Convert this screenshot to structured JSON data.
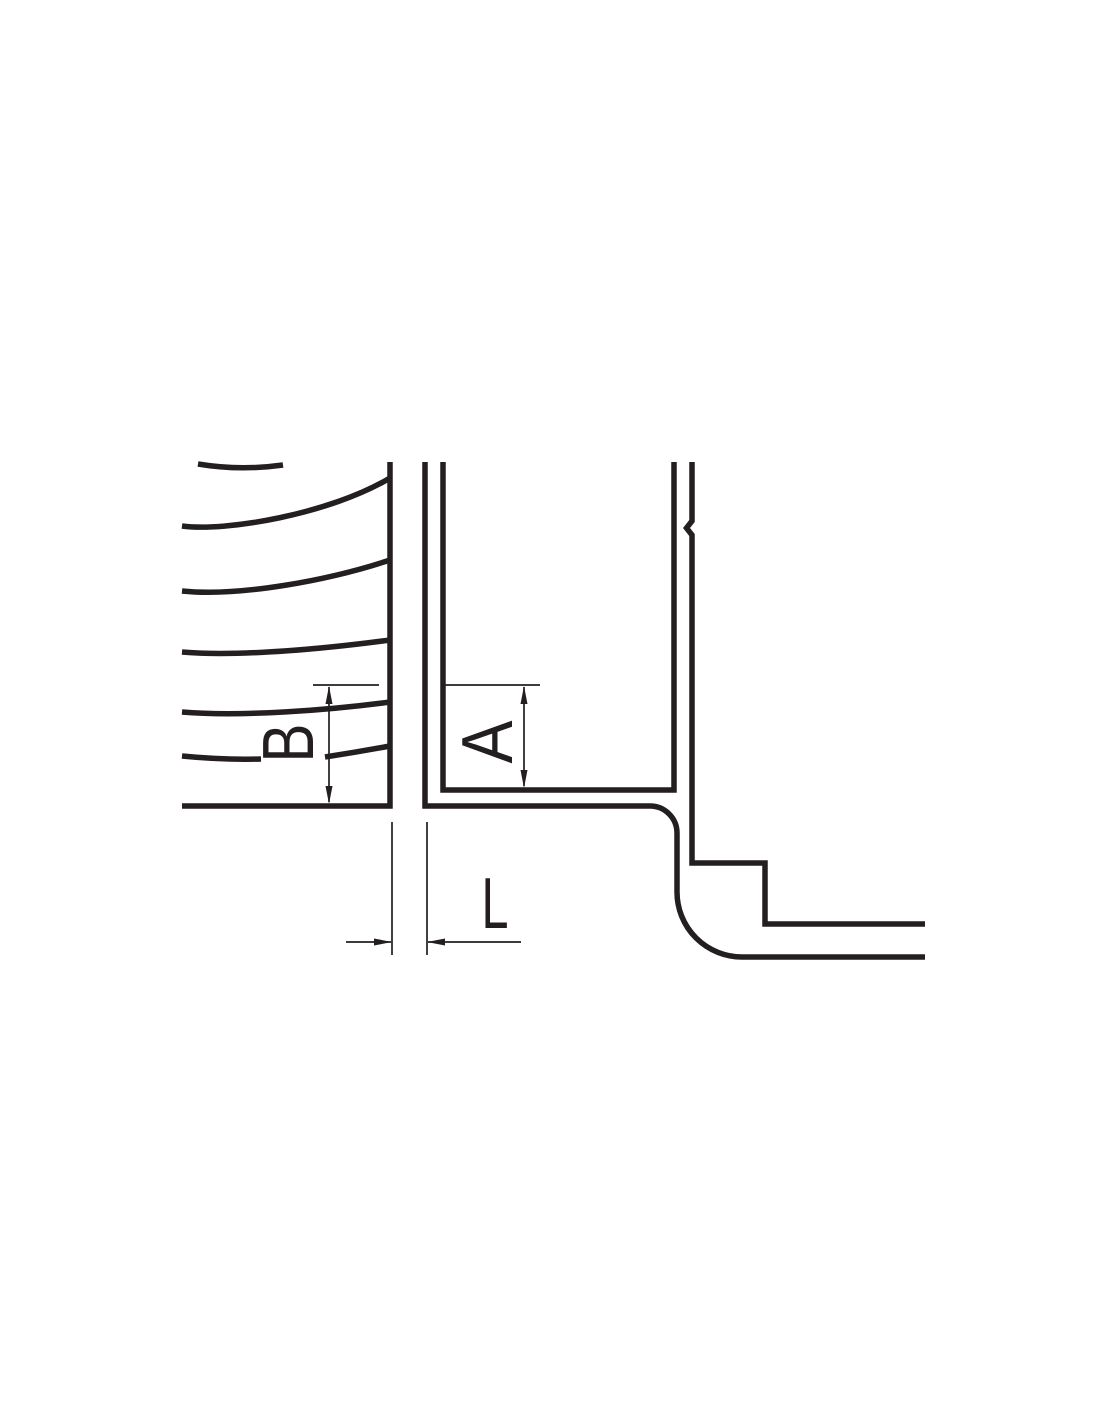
{
  "diagram": {
    "kind": "technical-cross-section",
    "description": "Pump impeller and casing seal-ring clearance detail drawing",
    "labels": {
      "dim_b": "B",
      "dim_a": "A",
      "dim_l": "L"
    },
    "colors": {
      "line": "#231f20",
      "background": "#ffffff"
    }
  }
}
